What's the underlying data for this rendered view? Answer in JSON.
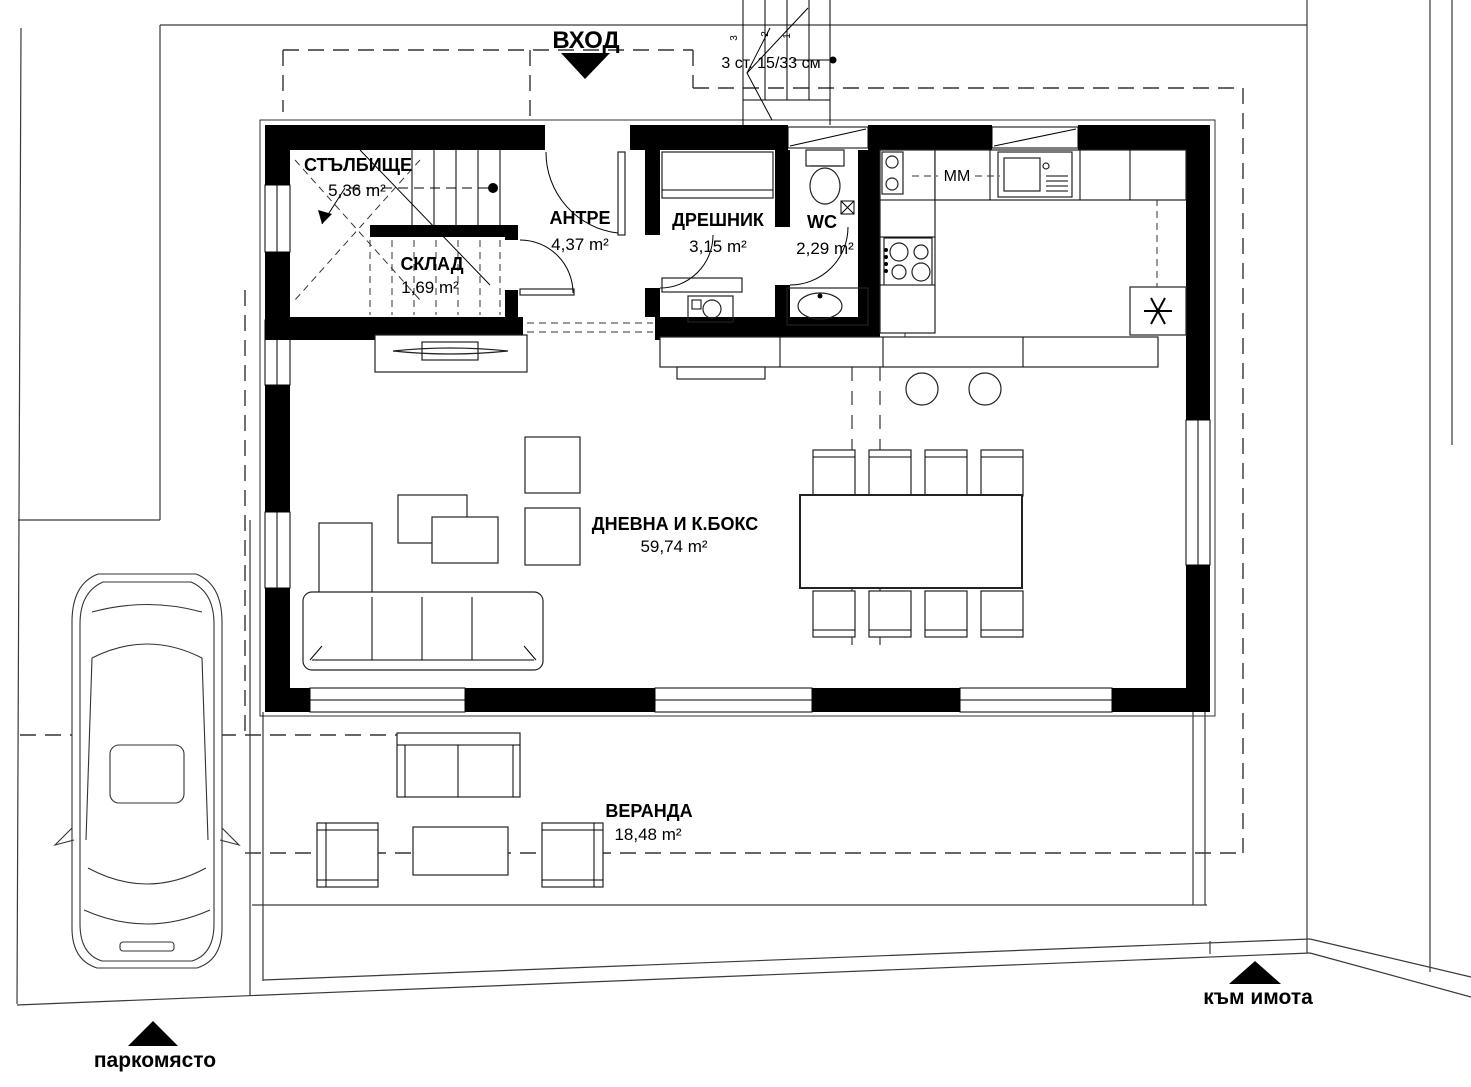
{
  "drawing": {
    "entrance_label": "ВХОД",
    "steps_note": "3 ст. 15/33 см",
    "step_numbers": [
      "3",
      "2",
      "1"
    ],
    "kitchen_note": "MM",
    "parking_label": "паркомясто",
    "to_property_label": "към имота",
    "rooms": [
      {
        "id": "stairwell",
        "name": "СТЪЛБИЩЕ",
        "area": "5,36 m²"
      },
      {
        "id": "storage",
        "name": "СКЛАД",
        "area": "1,69 m²"
      },
      {
        "id": "hall",
        "name": "АНТРЕ",
        "area": "4,37 m²"
      },
      {
        "id": "closet",
        "name": "ДРЕШНИК",
        "area": "3,15 m²"
      },
      {
        "id": "wc",
        "name": "WC",
        "area": "2,29 m²"
      },
      {
        "id": "living",
        "name": "ДНЕВНА И К.БОКС",
        "area": "59,74 m²"
      },
      {
        "id": "veranda",
        "name": "ВЕРАНДА",
        "area": "18,48 m²"
      }
    ],
    "icons": {
      "entrance_direction": "filled-triangle-down",
      "parking_direction": "filled-triangle-up",
      "to_property_direction": "filled-triangle-up",
      "fridge": "asterisk",
      "wc_vent": "crossed-box",
      "stair_walk_start": "dot"
    },
    "colors": {
      "ink": "#000000",
      "paper": "#ffffff"
    }
  }
}
